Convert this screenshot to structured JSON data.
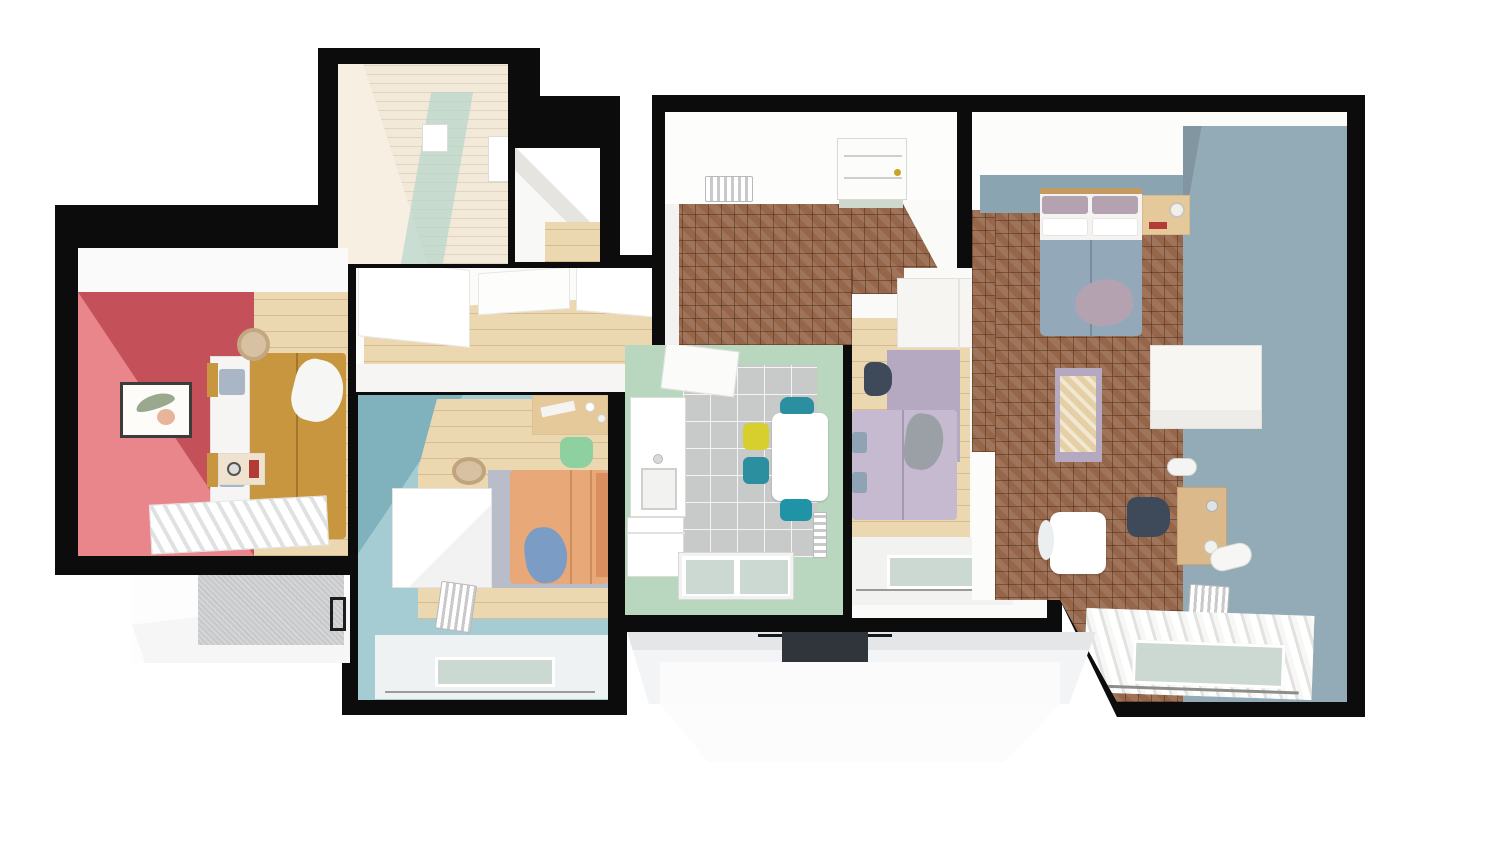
{
  "scene": {
    "type": "3d-floor-plan-top-view",
    "description": "Top-down 3D render of an apartment with seven spaces and two balconies on a white background with black cut walls"
  },
  "palette": {
    "wall_black": "#0c0c0c",
    "white": "#ffffff",
    "offwhite": "#f4f4f2",
    "cream_panel": "#f2e9d8",
    "glass_mint": "#b7d6cc",
    "red_wall_light": "#e8868c",
    "red_wall_dark": "#c4505a",
    "ochre_duvet": "#c8963e",
    "wood_light": "#ecd8b0",
    "parquet_brown": "#96664a",
    "mint_wall": "#b9d6bf",
    "tile_grey": "#c7cac9",
    "teal_wall": "#a6ccd3",
    "teal_wall_dark": "#7fb2bc",
    "blue_wall": "#93abb6",
    "blue_wall_strip": "#8aa5b1",
    "blue_duvet": "#93a9ba",
    "mauve_pillow": "#b5a2b0",
    "orange_duvet": "#e9a878",
    "orange_pillow": "#d98f5f",
    "lavender_duvet": "#c5bacf",
    "lavender_rug": "#b4a9c0",
    "grey_rug": "#b9bdc9",
    "blanket_blue": "#7b9cc5",
    "blanket_grey": "#9aa0a6",
    "chair_yellow": "#d6cf2e",
    "chair_teal": "#2b8fa0",
    "chair_green": "#8fd0a0",
    "chair_dark": "#3e4a5a",
    "desk_wood": "#dcb98a",
    "nightstand_wood": "#e5c99b",
    "balcony_wall_grey": "#c7c8ca",
    "grill_dark": "#2f353b",
    "art_pink": "#e2766f",
    "art_red": "#c94f49",
    "knob_gold": "#c9a227",
    "glass_pane": "#ccd9d2",
    "window_base": "#e9eae7",
    "steel_pillow": "#8fa3b5"
  },
  "rooms": [
    {
      "id": "bathroom-top-left",
      "walls": "cream wood panelling",
      "features": [
        "mint-glass-shower-screen",
        "white-cabinet",
        "wall-box"
      ]
    },
    {
      "id": "closet-nook",
      "walls": "white",
      "features": [
        "wood-floor-sliver"
      ]
    },
    {
      "id": "bedroom-red",
      "walls": "two-tone coral red",
      "floor": "light wood planks",
      "features": [
        "double-bed-ochre",
        "white-pillows",
        "blue-pillows",
        "white-throw",
        "wall-art-frame",
        "laundry-basket",
        "nightstand",
        "window-blinds"
      ]
    },
    {
      "id": "hallway",
      "walls": "white",
      "floor": "light wood",
      "features": [
        "built-in-wardrobes"
      ]
    },
    {
      "id": "entry-hall",
      "walls": "white",
      "floor": "brown-basketweave-parquet",
      "features": [
        "entrance-door-gold-knob",
        "doormat",
        "radiator-grille",
        "open-door-wedge"
      ]
    },
    {
      "id": "kitchen",
      "walls": "mint green",
      "floor": "grey tile",
      "features": [
        "counter-with-sink",
        "washing-machine",
        "dining-table",
        "chair-yellow",
        "chairs-teal-x3",
        "radiator",
        "window"
      ]
    },
    {
      "id": "bedroom-kids",
      "walls": "white",
      "floor": "light wood",
      "features": [
        "wardrobe",
        "lavender-rug",
        "single-bed-lavender",
        "grey-knit-blanket",
        "desk-chair-dark",
        "flamingo-art",
        "window-curtains"
      ]
    },
    {
      "id": "bedroom-teal",
      "walls": "teal",
      "floor": "light wood",
      "features": [
        "desk",
        "chair-green",
        "basket",
        "wardrobe-white",
        "single-bed-orange",
        "blue-blanket",
        "grey-rug",
        "radiator",
        "window-curtains"
      ]
    },
    {
      "id": "bedroom-master",
      "walls": "blue grey",
      "floor": "brown-basketweave-parquet",
      "features": [
        "double-bed-blue",
        "mauve-pillows",
        "nightstand-lamp",
        "wardrobe-white",
        "bench-rug-art",
        "desk-wood",
        "office-chair-dark",
        "side-table-white",
        "radiator",
        "window-curtains"
      ]
    }
  ],
  "balconies": [
    {
      "id": "balcony-left",
      "features": [
        "grey-textured-wall",
        "white-floor",
        "dark-railing"
      ]
    },
    {
      "id": "balcony-center",
      "features": [
        "white-floor",
        "ac-grille-dark",
        "angled-side-walls"
      ]
    }
  ]
}
